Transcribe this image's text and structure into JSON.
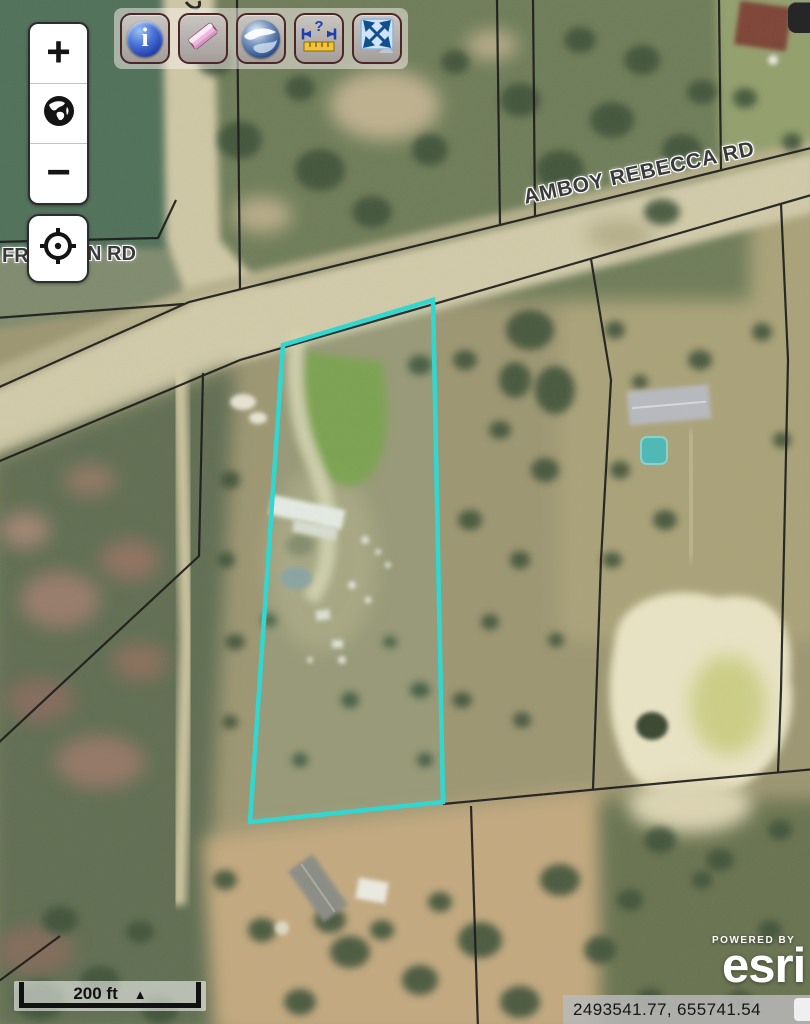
{
  "labels": {
    "road_main": "AMBOY REBECCA RD",
    "road_left_prefix": "FR",
    "road_left_suffix": "N RD"
  },
  "zoom_control": {
    "zoom_in": "+",
    "zoom_out": "−"
  },
  "toolbar": {
    "buttons": [
      {
        "icon": "info-icon"
      },
      {
        "icon": "eraser-icon"
      },
      {
        "icon": "google-earth-icon"
      },
      {
        "icon": "measure-icon"
      },
      {
        "icon": "fullscreen-icon"
      }
    ],
    "info_glyph": "i",
    "measure_glyph": "?"
  },
  "scale_bar": {
    "label": "200 ft",
    "triangle": "▲"
  },
  "status_bar": {
    "coordinates": "2493541.77, 655741.54"
  },
  "attribution": {
    "powered_by": "POWERED BY",
    "brand": "esri"
  },
  "colors": {
    "parcel_highlight": "#2BD9D3",
    "boundary_line": "#161616",
    "road_fill": "#d2cbaa",
    "selection_none": ""
  }
}
